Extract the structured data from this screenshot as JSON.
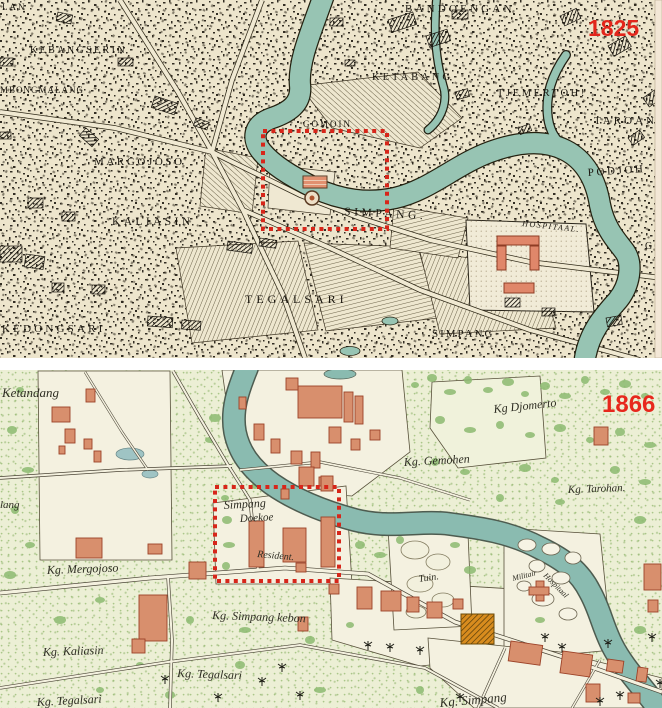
{
  "figure": {
    "description": "Two stacked historical city maps (Surabaya area) with red highlight boxes",
    "colors": {
      "map1825_bg": "#ede5cc",
      "map1825_ink": "#1a160f",
      "map1866_bg": "#ecefd5",
      "river": "#8fc0b2",
      "building_salmon": "#d88f6d",
      "building_orange": "#d88c1e",
      "tree_green": "#8cba70",
      "highlight_red": "#d7261a",
      "year_red": "#e3261c"
    }
  },
  "maps": [
    {
      "id": "map-1825",
      "year_label": "1825",
      "highlight_box": {
        "x": 263,
        "y": 131,
        "w": 124,
        "h": 98
      },
      "labels": [
        {
          "text": "LAN",
          "x": 2,
          "y": 10,
          "size": 9,
          "ls": 2
        },
        {
          "text": "BANDOENGAN",
          "x": 405,
          "y": 12,
          "size": 11,
          "ls": 3.2
        },
        {
          "text": "KEBANGSERIN",
          "x": 30,
          "y": 53,
          "size": 10,
          "ls": 2.4
        },
        {
          "text": "KETABANG",
          "x": 372,
          "y": 80,
          "size": 10.5,
          "ls": 3
        },
        {
          "text": "TJEMERTOH!",
          "x": 497,
          "y": 96,
          "size": 10.5,
          "ls": 2.6
        },
        {
          "text": "TAROAN",
          "x": 594,
          "y": 124,
          "size": 11,
          "ls": 3
        },
        {
          "text": "MBONGMALANG",
          "x": 0,
          "y": 93,
          "size": 9,
          "ls": 1
        },
        {
          "text": "GOMOIN",
          "x": 303,
          "y": 127,
          "size": 9,
          "ls": 2
        },
        {
          "text": "MARGOJOSO",
          "x": 94,
          "y": 165,
          "size": 11,
          "ls": 2.6
        },
        {
          "text": "KALIASIN",
          "x": 112,
          "y": 225,
          "size": 11.5,
          "ls": 3.4
        },
        {
          "text": "SIMPANG.",
          "x": 344,
          "y": 215,
          "size": 11.5,
          "ls": 3.6,
          "rot": 3
        },
        {
          "text": "PODJOH",
          "x": 588,
          "y": 176,
          "size": 11,
          "ls": 2.6,
          "rot": -4
        },
        {
          "text": "HOSPITAAL.",
          "x": 522,
          "y": 226,
          "size": 8,
          "ls": 1.5,
          "rot": 6,
          "em": true
        },
        {
          "text": "TEGALSARI",
          "x": 245,
          "y": 303,
          "size": 12,
          "ls": 4
        },
        {
          "text": "KEDONGSARI",
          "x": 2,
          "y": 332,
          "size": 11,
          "ls": 3.2
        },
        {
          "text": "SIMPANG",
          "x": 432,
          "y": 337,
          "size": 11,
          "ls": 2
        },
        {
          "text": "GO",
          "x": 645,
          "y": 249,
          "size": 10,
          "ls": 2
        }
      ]
    },
    {
      "id": "map-1866",
      "year_label": "1866",
      "highlight_box": {
        "x": 215,
        "y": 487,
        "w": 124,
        "h": 94
      },
      "labels": [
        {
          "text": "Ketandang",
          "x": 2,
          "y": 397,
          "size": 13
        },
        {
          "text": "lang",
          "x": 0,
          "y": 508,
          "size": 11
        },
        {
          "text": "Kg Djomerto",
          "x": 494,
          "y": 413,
          "size": 12,
          "rot": -6
        },
        {
          "text": "Kg. Gemohen",
          "x": 404,
          "y": 466,
          "size": 12,
          "rot": -3
        },
        {
          "text": "Kg. Tarohan.",
          "x": 568,
          "y": 493,
          "size": 11,
          "rot": -2
        },
        {
          "text": "Simpang",
          "x": 224,
          "y": 509,
          "size": 12,
          "rot": -3,
          "color": "#24504a"
        },
        {
          "text": "Doekoe",
          "x": 240,
          "y": 522,
          "size": 11,
          "rot": -3,
          "color": "#24504a"
        },
        {
          "text": "Resident.",
          "x": 257,
          "y": 557,
          "size": 10,
          "rot": 5
        },
        {
          "text": "Kg. Mergojoso",
          "x": 47,
          "y": 574,
          "size": 12,
          "rot": -2
        },
        {
          "text": "Kg. Simpang kebon",
          "x": 212,
          "y": 619,
          "size": 12,
          "rot": 2
        },
        {
          "text": "Tuin.",
          "x": 419,
          "y": 582,
          "size": 10,
          "rot": -8
        },
        {
          "text": "Militair",
          "x": 513,
          "y": 581,
          "size": 8,
          "rot": -14
        },
        {
          "text": "Hospitaal",
          "x": 543,
          "y": 576,
          "size": 8,
          "rot": 45
        },
        {
          "text": "Kg. Kaliasin",
          "x": 43,
          "y": 656,
          "size": 12,
          "rot": -2
        },
        {
          "text": "Kg. Tegalsari",
          "x": 177,
          "y": 677,
          "size": 12,
          "rot": 2
        },
        {
          "text": "Kg. Tegalsari",
          "x": 37,
          "y": 706,
          "size": 12,
          "rot": -3
        },
        {
          "text": "Kg. Simpang",
          "x": 440,
          "y": 707,
          "size": 13,
          "rot": -5
        }
      ]
    }
  ]
}
